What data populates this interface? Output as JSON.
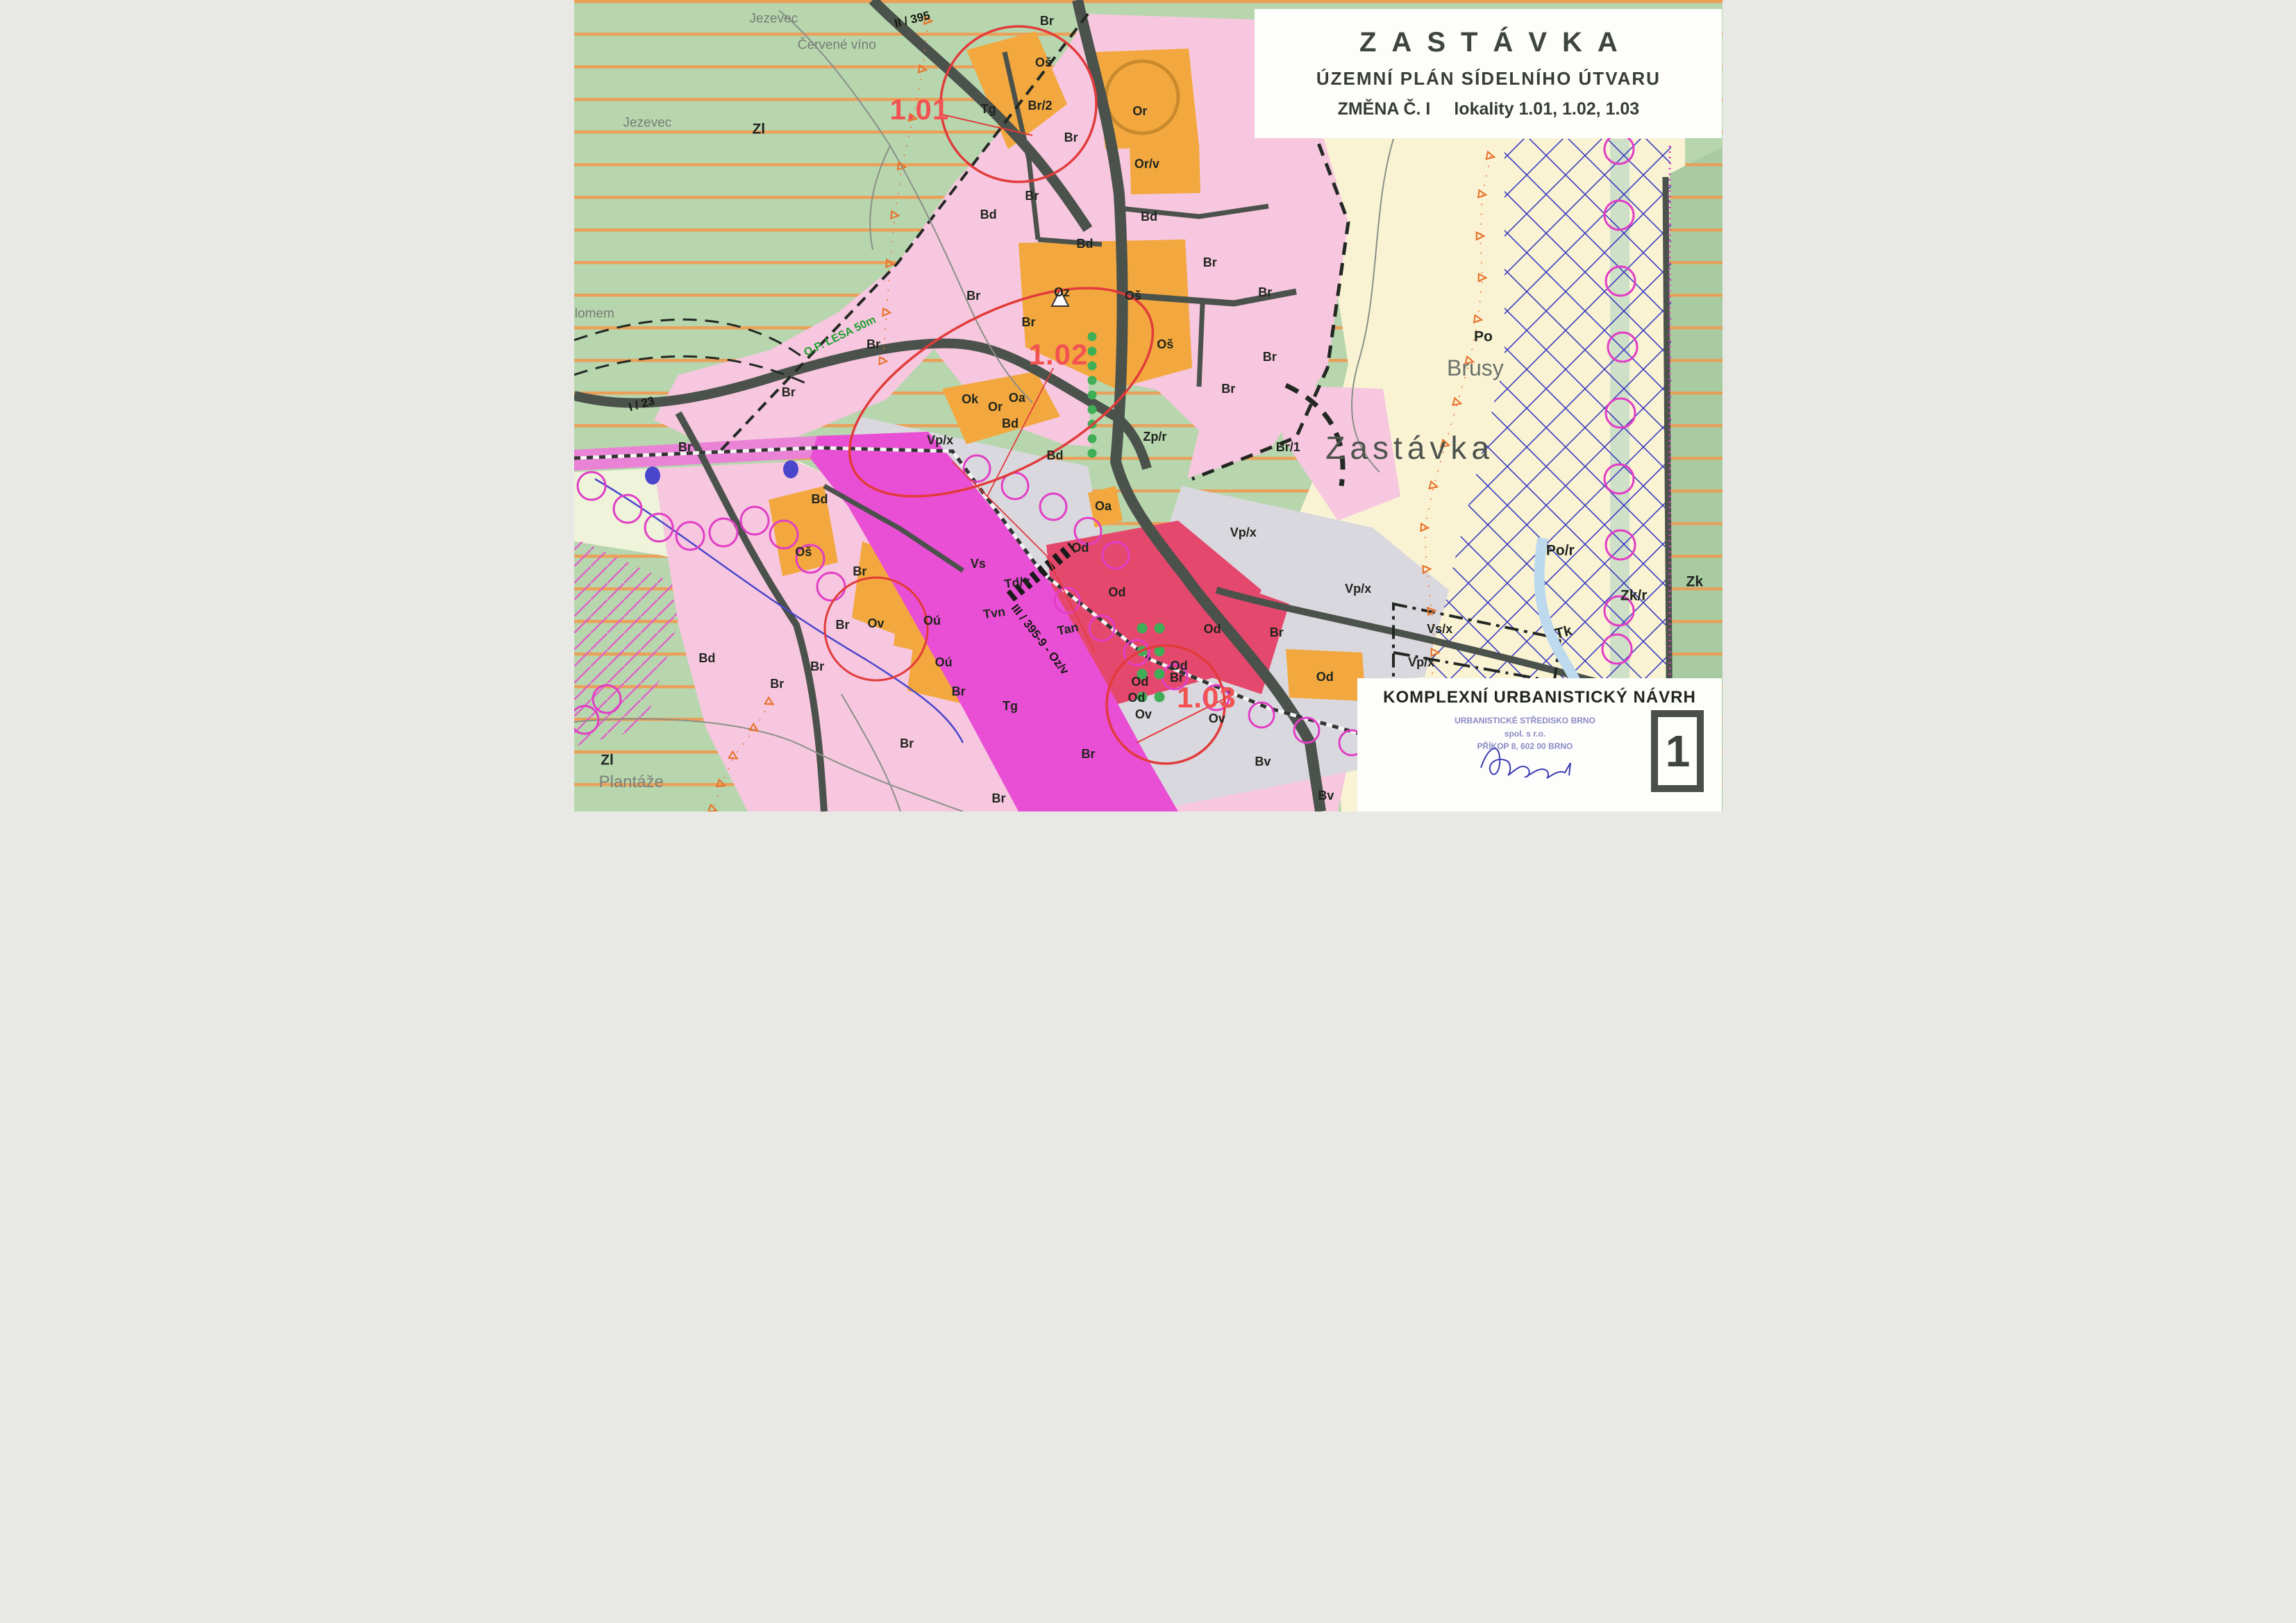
{
  "title_block": {
    "town": "ZASTÁVKA",
    "subtitle": "ÚZEMNÍ PLÁN SÍDELNÍHO ÚTVARU",
    "change_label": "ZMĚNA Č. I",
    "localities_label": "lokality 1.01, 1.02, 1.03"
  },
  "footer_block": {
    "title": "KOMPLEXNÍ URBANISTICKÝ NÁVRH",
    "stamp_line1": "URBANISTICKÉ STŘEDISKO BRNO",
    "stamp_line2": "spol. s r.o.",
    "stamp_line3": "PŘÍKOP 8, 602 00 BRNO",
    "sheet_number": "1"
  },
  "colors": {
    "meadow_green": "#b7d6ae",
    "stripe_orange": "#f09a50",
    "residential_pink": "#f6c7de",
    "zone_orange": "#f2a83e",
    "commercial_crimson": "#e5486d",
    "corridor_magenta": "#e94fd4",
    "industrial_gray": "#d9d8de",
    "field_cream": "#f9f3d4",
    "crosshatch_blue": "#3b3bc0",
    "locality_red": "#f25252",
    "stamp_blue": "#8b8bc6",
    "road_dark": "#4b514b"
  },
  "map": {
    "labels": [
      {
        "t": "1.01",
        "x": 30.1,
        "y": 13.5,
        "c": "loc"
      },
      {
        "t": "1.02",
        "x": 42.2,
        "y": 43.7,
        "c": "loc"
      },
      {
        "t": "1.03",
        "x": 55.1,
        "y": 86.0,
        "c": "loc"
      },
      {
        "t": "II / 395",
        "x": 29.5,
        "y": 2.4,
        "c": "r",
        "r": -14
      },
      {
        "t": "I / 23",
        "x": 5.9,
        "y": 49.8,
        "c": "r",
        "r": -16
      },
      {
        "t": "III / 395-9 - Oz/v",
        "x": 40.6,
        "y": 78.8,
        "c": "r",
        "r": 52
      },
      {
        "t": "Jezevec",
        "x": 17.4,
        "y": 2.3,
        "c": "p"
      },
      {
        "t": "Červené víno",
        "x": 22.9,
        "y": 5.6,
        "c": "p"
      },
      {
        "t": "Jezevec",
        "x": 6.4,
        "y": 15.1,
        "c": "p"
      },
      {
        "t": "lomem",
        "x": 1.8,
        "y": 38.7,
        "c": "p"
      },
      {
        "t": "Brusy",
        "x": 78.5,
        "y": 45.3,
        "c": "pl"
      },
      {
        "t": "Zastávka",
        "x": 72.8,
        "y": 55.2,
        "c": "pxl"
      },
      {
        "t": "Plantáže",
        "x": 5.0,
        "y": 96.4,
        "c": "pl2"
      },
      {
        "t": "O.P. LESA 50m",
        "x": 23.2,
        "y": 41.5,
        "c": "grn",
        "r": -26
      },
      {
        "t": "Zl",
        "x": 16.1,
        "y": 15.9,
        "c": "zl"
      },
      {
        "t": "Zl",
        "x": 2.9,
        "y": 93.7,
        "c": "zl"
      },
      {
        "t": "Po",
        "x": 79.2,
        "y": 41.5,
        "c": "zl"
      },
      {
        "t": "Po/r",
        "x": 85.9,
        "y": 67.8,
        "c": "zl"
      },
      {
        "t": "Zk/r",
        "x": 92.3,
        "y": 73.4,
        "c": "zl"
      },
      {
        "t": "Zk",
        "x": 97.6,
        "y": 71.7,
        "c": "zl"
      },
      {
        "t": "Tk",
        "x": 86.2,
        "y": 77.9,
        "c": "zl",
        "r": -14
      },
      {
        "t": "Br",
        "x": 41.2,
        "y": 2.6,
        "c": "z"
      },
      {
        "t": "Oš",
        "x": 40.9,
        "y": 7.7,
        "c": "z"
      },
      {
        "t": "Tg",
        "x": 36.1,
        "y": 13.4,
        "c": "z"
      },
      {
        "t": "Br/2",
        "x": 40.6,
        "y": 13.0,
        "c": "z"
      },
      {
        "t": "Or",
        "x": 49.3,
        "y": 13.7,
        "c": "z"
      },
      {
        "t": "Br",
        "x": 43.3,
        "y": 16.9,
        "c": "z"
      },
      {
        "t": "Or/v",
        "x": 49.9,
        "y": 20.2,
        "c": "z"
      },
      {
        "t": "Br",
        "x": 39.9,
        "y": 24.1,
        "c": "z"
      },
      {
        "t": "Bd",
        "x": 36.1,
        "y": 26.4,
        "c": "z"
      },
      {
        "t": "Bd",
        "x": 50.1,
        "y": 26.7,
        "c": "z"
      },
      {
        "t": "Bd",
        "x": 44.5,
        "y": 30.0,
        "c": "z"
      },
      {
        "t": "Br",
        "x": 55.4,
        "y": 32.3,
        "c": "z"
      },
      {
        "t": "Oz",
        "x": 42.5,
        "y": 36.0,
        "c": "z"
      },
      {
        "t": "Oš",
        "x": 48.7,
        "y": 36.4,
        "c": "z"
      },
      {
        "t": "Br",
        "x": 60.2,
        "y": 36.0,
        "c": "z"
      },
      {
        "t": "Br",
        "x": 34.8,
        "y": 36.4,
        "c": "z"
      },
      {
        "t": "Br",
        "x": 39.6,
        "y": 39.7,
        "c": "z"
      },
      {
        "t": "Br",
        "x": 26.1,
        "y": 42.4,
        "c": "z"
      },
      {
        "t": "Oš",
        "x": 51.5,
        "y": 42.4,
        "c": "z"
      },
      {
        "t": "Br",
        "x": 60.6,
        "y": 44.0,
        "c": "z"
      },
      {
        "t": "Br",
        "x": 18.7,
        "y": 48.3,
        "c": "z"
      },
      {
        "t": "Br",
        "x": 57.0,
        "y": 47.9,
        "c": "z"
      },
      {
        "t": "Ok",
        "x": 34.5,
        "y": 49.2,
        "c": "z"
      },
      {
        "t": "Or",
        "x": 36.7,
        "y": 50.1,
        "c": "z"
      },
      {
        "t": "Oa",
        "x": 38.6,
        "y": 49.0,
        "c": "z"
      },
      {
        "t": "Bd",
        "x": 38.0,
        "y": 52.2,
        "c": "z"
      },
      {
        "t": "Vp/x",
        "x": 31.9,
        "y": 54.2,
        "c": "z"
      },
      {
        "t": "Bd",
        "x": 41.9,
        "y": 56.1,
        "c": "z"
      },
      {
        "t": "Zp/r",
        "x": 50.6,
        "y": 53.8,
        "c": "z"
      },
      {
        "t": "Br/1",
        "x": 62.2,
        "y": 55.1,
        "c": "z"
      },
      {
        "t": "Br",
        "x": 9.7,
        "y": 55.1,
        "c": "z"
      },
      {
        "t": "Bd",
        "x": 21.4,
        "y": 61.5,
        "c": "z"
      },
      {
        "t": "Oa",
        "x": 46.1,
        "y": 62.4,
        "c": "z"
      },
      {
        "t": "Oš",
        "x": 20.0,
        "y": 68.0,
        "c": "z"
      },
      {
        "t": "Br",
        "x": 24.9,
        "y": 70.4,
        "c": "z"
      },
      {
        "t": "Vs",
        "x": 35.2,
        "y": 69.5,
        "c": "z"
      },
      {
        "t": "Vp/x",
        "x": 58.3,
        "y": 65.6,
        "c": "z"
      },
      {
        "t": "Od",
        "x": 44.1,
        "y": 67.5,
        "c": "z"
      },
      {
        "t": "Br",
        "x": 23.4,
        "y": 77.0,
        "c": "z"
      },
      {
        "t": "Ov",
        "x": 26.3,
        "y": 76.8,
        "c": "z"
      },
      {
        "t": "Td/v",
        "x": 38.6,
        "y": 71.8,
        "c": "z",
        "r": -8
      },
      {
        "t": "Od",
        "x": 47.3,
        "y": 73.0,
        "c": "z"
      },
      {
        "t": "Tvn",
        "x": 36.6,
        "y": 75.5,
        "c": "z",
        "r": -8
      },
      {
        "t": "Oú",
        "x": 31.2,
        "y": 76.5,
        "c": "z"
      },
      {
        "t": "Tan",
        "x": 43.0,
        "y": 77.5,
        "c": "z",
        "r": -12
      },
      {
        "t": "Od",
        "x": 55.6,
        "y": 77.5,
        "c": "z"
      },
      {
        "t": "Vp/x",
        "x": 68.3,
        "y": 72.5,
        "c": "z"
      },
      {
        "t": "Vs/x",
        "x": 75.4,
        "y": 77.5,
        "c": "z"
      },
      {
        "t": "Vp/x",
        "x": 73.8,
        "y": 81.6,
        "c": "z"
      },
      {
        "t": "Od",
        "x": 52.7,
        "y": 82.0,
        "c": "z"
      },
      {
        "t": "Br",
        "x": 61.2,
        "y": 77.9,
        "c": "z"
      },
      {
        "t": "Bd",
        "x": 11.6,
        "y": 81.1,
        "c": "z"
      },
      {
        "t": "Br",
        "x": 21.2,
        "y": 82.1,
        "c": "z"
      },
      {
        "t": "Oú",
        "x": 32.2,
        "y": 81.6,
        "c": "z"
      },
      {
        "t": "Od",
        "x": 49.3,
        "y": 84.0,
        "c": "z"
      },
      {
        "t": "Br",
        "x": 52.5,
        "y": 83.5,
        "c": "z"
      },
      {
        "t": "Od",
        "x": 65.4,
        "y": 83.4,
        "c": "z"
      },
      {
        "t": "Br",
        "x": 17.7,
        "y": 84.3,
        "c": "z"
      },
      {
        "t": "Od",
        "x": 49.0,
        "y": 86.0,
        "c": "z"
      },
      {
        "t": "Ov",
        "x": 49.6,
        "y": 88.0,
        "c": "z"
      },
      {
        "t": "Ov",
        "x": 56.0,
        "y": 88.5,
        "c": "z"
      },
      {
        "t": "Br",
        "x": 33.5,
        "y": 85.2,
        "c": "z"
      },
      {
        "t": "Tg",
        "x": 38.0,
        "y": 87.0,
        "c": "z"
      },
      {
        "t": "Br",
        "x": 29.0,
        "y": 91.6,
        "c": "z"
      },
      {
        "t": "Br",
        "x": 44.8,
        "y": 92.9,
        "c": "z"
      },
      {
        "t": "Bv",
        "x": 60.0,
        "y": 93.8,
        "c": "z"
      },
      {
        "t": "Bv",
        "x": 65.5,
        "y": 98.0,
        "c": "z"
      },
      {
        "t": "Br",
        "x": 37.0,
        "y": 98.4,
        "c": "z"
      }
    ]
  }
}
